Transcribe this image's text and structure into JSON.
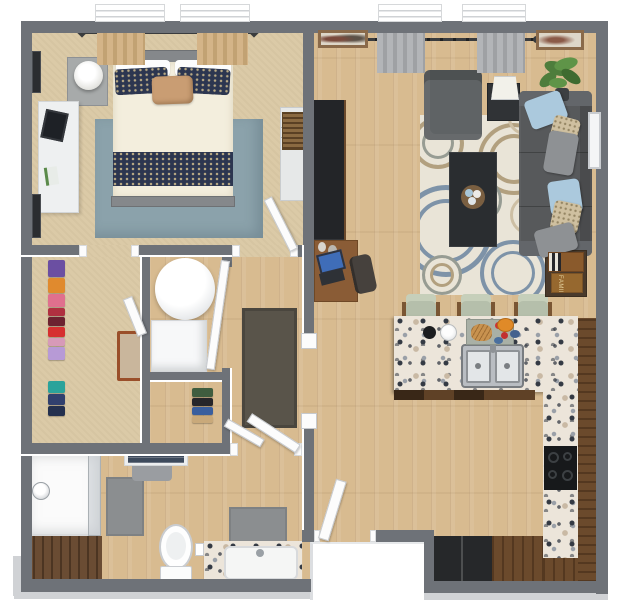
{
  "scene": {
    "type": "3d-floorplan-top-view",
    "subject": "one-bedroom apartment with open living-kitchen area, walk-in closet, hallway, bathroom and entry"
  },
  "labels": {
    "game_box": "FAMILY"
  },
  "colors": {
    "wall": "#6e7278",
    "doorWhite": "#fcfcfc",
    "doorEdge": "#c6c9cd",
    "foundation": "#d0d2d5",
    "wood": "#d8bb90",
    "carpet": "#dbcaa7",
    "bedroomRug": "#8ba2ab",
    "duvet": "#f3eedd",
    "pillowNavy": "#2c3650",
    "accentPillow": "#c99d73",
    "bedFrame": "#85888b",
    "nightstand": "#a7aaaa",
    "deskWhite": "#eef0f1",
    "frameDark": "#2b2d30",
    "dresserWhite": "#e6e8e8",
    "basket": "#8a6a42",
    "curtainTan": "#d4b488",
    "curtainGray": "#b3b5b8",
    "rod": "#3a3c3e",
    "sofa": "#57595b",
    "armchair": "#5f6365",
    "pillowBlue": "#abc9dd",
    "pillowTan": "#cfc0a0",
    "pillowGray": "#8e9194",
    "rugBase": "#e9e4d7",
    "rugBlue": "#7e93a8",
    "rugTan": "#b2a07f",
    "rugGray": "#979c93",
    "coffeeTable": "#2a2d30",
    "console": "#232528",
    "deskBrown": "#8a5c36",
    "chairDark": "#46413d",
    "plant": "#4e7d3c",
    "plantLight": "#5f9448",
    "pot": "#3c3f42",
    "granite": "#ece5da",
    "speckDark": "#343a44",
    "speckGray": "#9aa0a8",
    "speckTan": "#c9b9a4",
    "cabBrown": "#6b4a2c",
    "cabDark": "#5f4126",
    "fridge": "#26282a",
    "cooktop": "#17191b",
    "stoolSeat": "#b5bfab",
    "stoolBack": "#c6cfba",
    "stoolArm": "#7a5634",
    "steel": "#b9bdc2",
    "basin": "#e3e6e8",
    "matGray": "#8b8e90",
    "shower": "#fbfbfb",
    "vanityCab": "#6a4c33",
    "towelNavy": "#3d4a5c",
    "towelGray": "#9a9da1",
    "doormat": "#59544a",
    "gameWood": "#8a5a2c",
    "gameWood2": "#96682f",
    "gameText": "#e5d3a0",
    "laptopBlue": "#3f6db8"
  },
  "rooms": {
    "bedroom": {
      "name": "bedroom",
      "furniture": [
        "bed with navy floral bedding",
        "tan accent pillow",
        "blue-gray area rug",
        "nightstand",
        "table lamp",
        "white desk with tablet",
        "wall art frames",
        "tan curtains",
        "dresser with woven basket"
      ]
    },
    "living_room": {
      "name": "living room",
      "furniture": [
        "charcoal sofa",
        "throw pillows",
        "gray armchair",
        "black coffee table",
        "decor tray",
        "floral area rug",
        "media console",
        "writing desk with laptop",
        "desk chair",
        "lamp side table",
        "potted plant",
        "board game table",
        "wall art",
        "gray curtains"
      ]
    },
    "kitchen": {
      "name": "kitchen",
      "furniture": [
        "granite breakfast bar",
        "double sink",
        "three bar stools",
        "cooktop",
        "refrigerator",
        "lower cabinets",
        "cutting board with food"
      ]
    },
    "bathroom": {
      "name": "bathroom",
      "furniture": [
        "walk-in shower",
        "vanity with sink",
        "toilet",
        "bath mats",
        "linen shelf with towels",
        "storage cabinet"
      ]
    },
    "walk_in_closet": {
      "name": "walk-in closet",
      "furniture": [
        "hanging clothes",
        "luggage rack"
      ]
    },
    "utility_closet": {
      "name": "utility closet",
      "furniture": [
        "water heater",
        "washer"
      ]
    },
    "coat_closet": {
      "name": "coat closet",
      "furniture": [
        "hanging coats"
      ]
    },
    "hallway": {
      "name": "hallway",
      "furniture": [
        "doormat rug"
      ]
    },
    "entry": {
      "name": "entry",
      "furniture": [
        "front door",
        "exterior landing"
      ]
    }
  },
  "closet": {
    "clothes_colors": [
      "#6b4fa2",
      "#e08a2e",
      "#e0708e",
      "#b03040",
      "#6d2230",
      "#d62f2f",
      "#d79ab8",
      "#b79ad6",
      "#2ba39b",
      "#31406e",
      "#24304e"
    ]
  },
  "coat_closet": {
    "clothes_colors": [
      "#3f5d3f",
      "#26262a",
      "#3a5f9e",
      "#c9a97a"
    ]
  }
}
